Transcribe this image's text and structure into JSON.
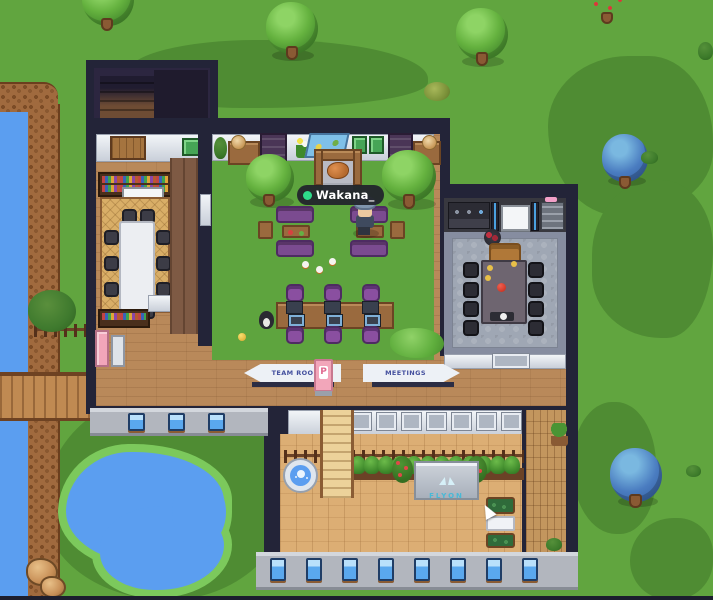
{
  "player": {
    "name": "Wakana_",
    "status": "online",
    "status_color": "#2edb8a"
  },
  "signs": {
    "team_rooms": {
      "label": "TEAM ROOMS",
      "direction": "left"
    },
    "meetings": {
      "label": "MEETINGS",
      "direction": "right"
    }
  },
  "portal": {
    "label": "P"
  },
  "billboard": {
    "brand": "FLYON",
    "accent_color": "#49b9d6"
  },
  "palette": {
    "grass": "#61a53f",
    "grass_dark": "#4f8c33",
    "water": "#5b9ef0",
    "wall_navy": "#232438",
    "wood_floor": "#b9895a",
    "deck_floor": "#dcae74",
    "stone_wall": "#b2b6be",
    "window_blue": "#5aa8ee",
    "sofa_purple": "#7b4b90",
    "sign_text": "#44509e",
    "nametag_bg": "#22252c",
    "status_green": "#2edb8a"
  }
}
